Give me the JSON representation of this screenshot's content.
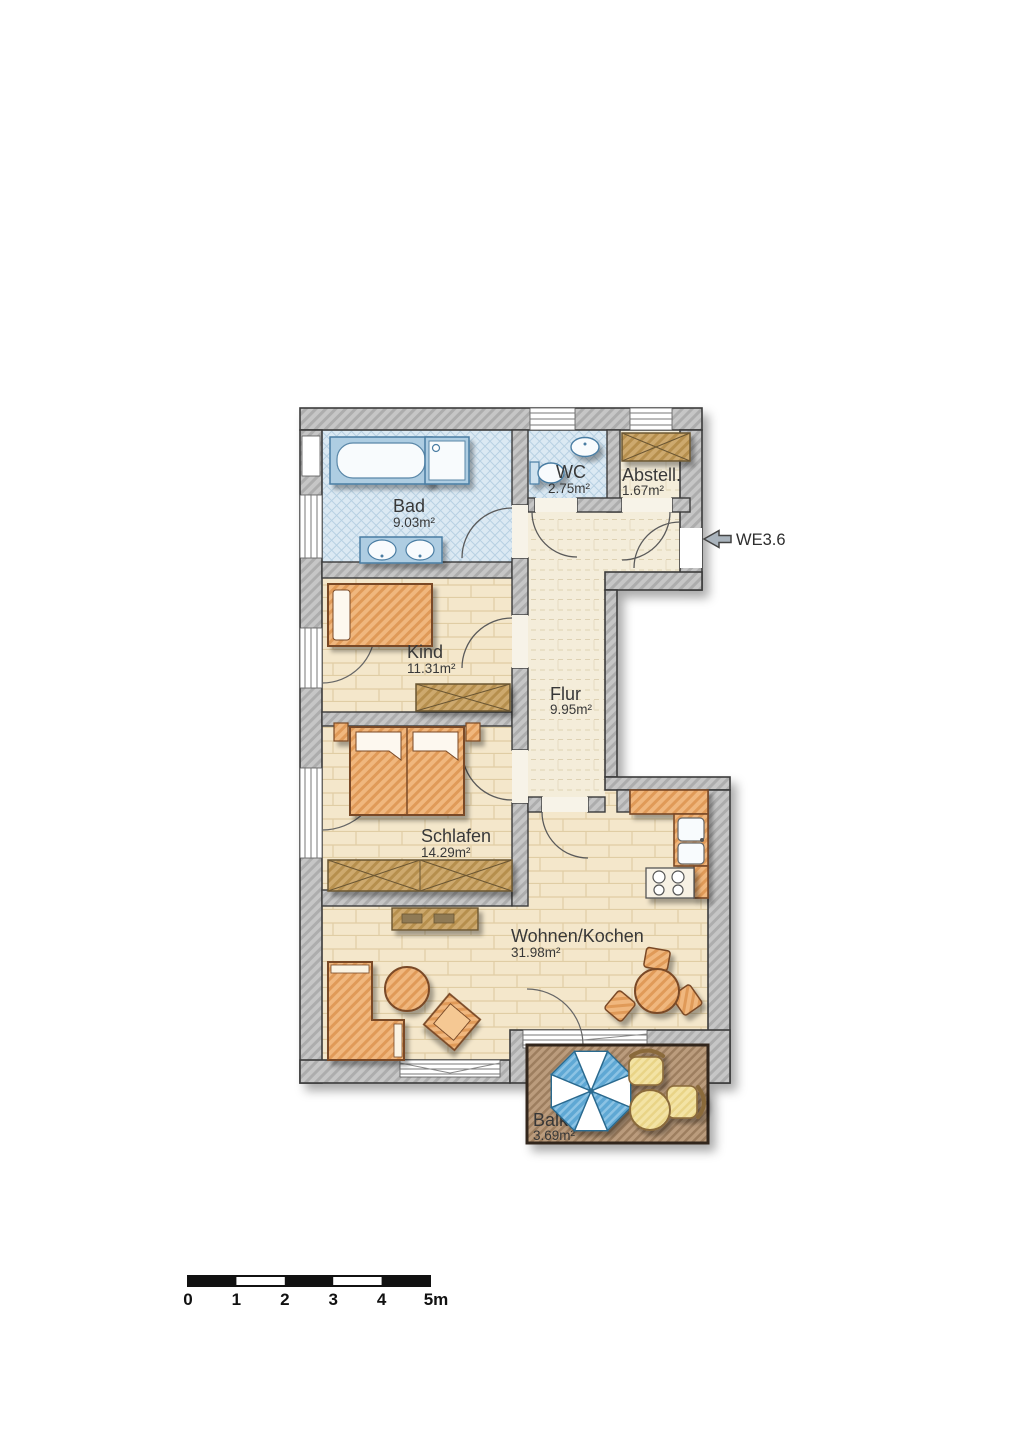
{
  "floorplan": {
    "unit_label": "WE3.6",
    "rooms": [
      {
        "id": "bad",
        "name": "Bad",
        "area": "9.03m²"
      },
      {
        "id": "wc",
        "name": "WC",
        "area": "2.75m²"
      },
      {
        "id": "abstell",
        "name": "Abstell.",
        "area": "1.67m²"
      },
      {
        "id": "kind",
        "name": "Kind",
        "area": "11.31m²"
      },
      {
        "id": "flur",
        "name": "Flur",
        "area": "9.95m²"
      },
      {
        "id": "schlafen",
        "name": "Schlafen",
        "area": "14.29m²"
      },
      {
        "id": "wohnen_kochen",
        "name": "Wohnen/Kochen",
        "area": "31.98m²"
      },
      {
        "id": "balkon",
        "name": "Balk.",
        "area": "3.69m²"
      }
    ],
    "scale_bar": {
      "labels": [
        "0",
        "1",
        "2",
        "3",
        "4",
        "5m"
      ]
    },
    "colors": {
      "wall": "#c6c6c6",
      "bath_tile": "#dbe9f3",
      "wood_floor": "#f4e7cb",
      "hall_floor": "#f4edda",
      "furniture_orange": "#f0b77e",
      "wardrobe_tan": "#cda96e",
      "balcony_deck": "#bb9c7d",
      "umbrella_blue": "#5fa8d4",
      "outdoor_furniture_yellow": "#f3e3a4",
      "fixture_blue": "#b8d4e6"
    }
  }
}
